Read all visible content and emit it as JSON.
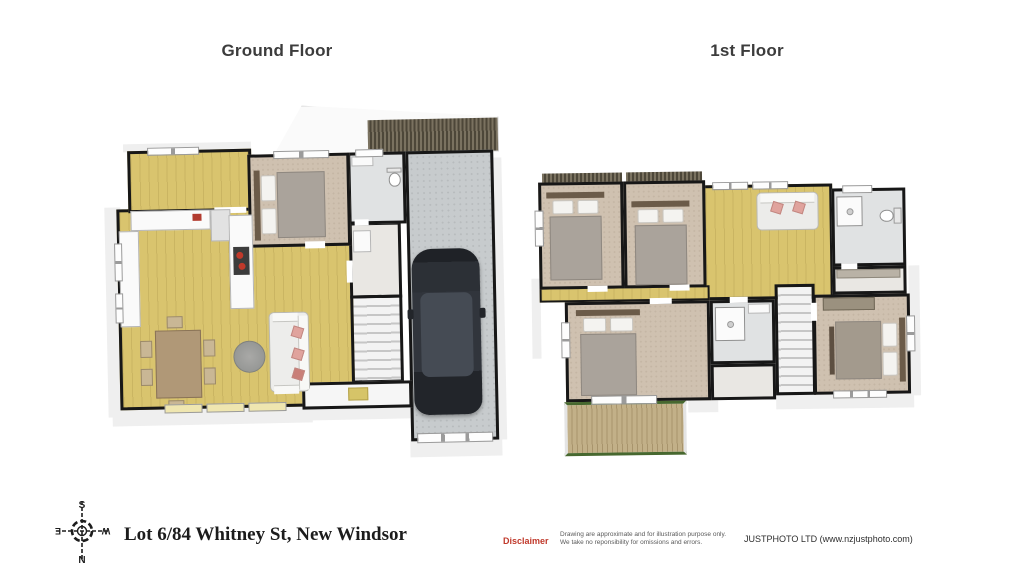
{
  "sheet": {
    "background": "#ffffff",
    "floors": [
      {
        "label": "Ground Floor",
        "rooms": [
          "entry",
          "kitchen",
          "living-dining",
          "bedroom",
          "bathroom",
          "laundry-hall",
          "stairs",
          "porch",
          "garage"
        ],
        "furniture": [
          "kitchen-counter",
          "fridge",
          "cooktop",
          "dining-table",
          "dining-chairs-x6",
          "round-rug",
          "sofa",
          "double-bed",
          "toilet",
          "vanity",
          "car",
          "garage-door",
          "door-mat"
        ]
      },
      {
        "label": "1st Floor",
        "rooms": [
          "bedroom-1",
          "bedroom-2",
          "landing",
          "bathroom",
          "walk-in-wardrobe",
          "master-bedroom",
          "bedroom-3",
          "ensuite",
          "closet",
          "stairs",
          "balcony"
        ],
        "furniture": [
          "double-bed-x4",
          "loveseat",
          "toilet",
          "shower-x2",
          "vanity",
          "built-in-wardrobe",
          "shelf"
        ]
      }
    ],
    "compass": {
      "north": "N",
      "south": "S",
      "east": "E",
      "west": "W"
    },
    "footer": {
      "address": "Lot 6/84 Whitney St, New Windsor",
      "disclaimer_label": "Disclaimer",
      "disclaimer_line1": "Drawing are approximate and for illustration purpose only.",
      "disclaimer_line2": "We take no reponsibility for omissions and errors.",
      "company": "JUSTPHOTO LTD (www.nzjustphoto.com)"
    },
    "colors": {
      "wall": "#171717",
      "wood_floor": "#d9c46e",
      "carpet": "#cfc1b0",
      "tile": "#e0e2e3",
      "garage_floor": "#c7cbcd",
      "balcony_rail_green": "#47682f",
      "balcony_deck": "#bfae86",
      "disclaimer_red": "#c0392b",
      "pillow_pink": "#e0a39d",
      "car_body": "#2b2f35",
      "cooktop_red": "#c0392b"
    }
  }
}
